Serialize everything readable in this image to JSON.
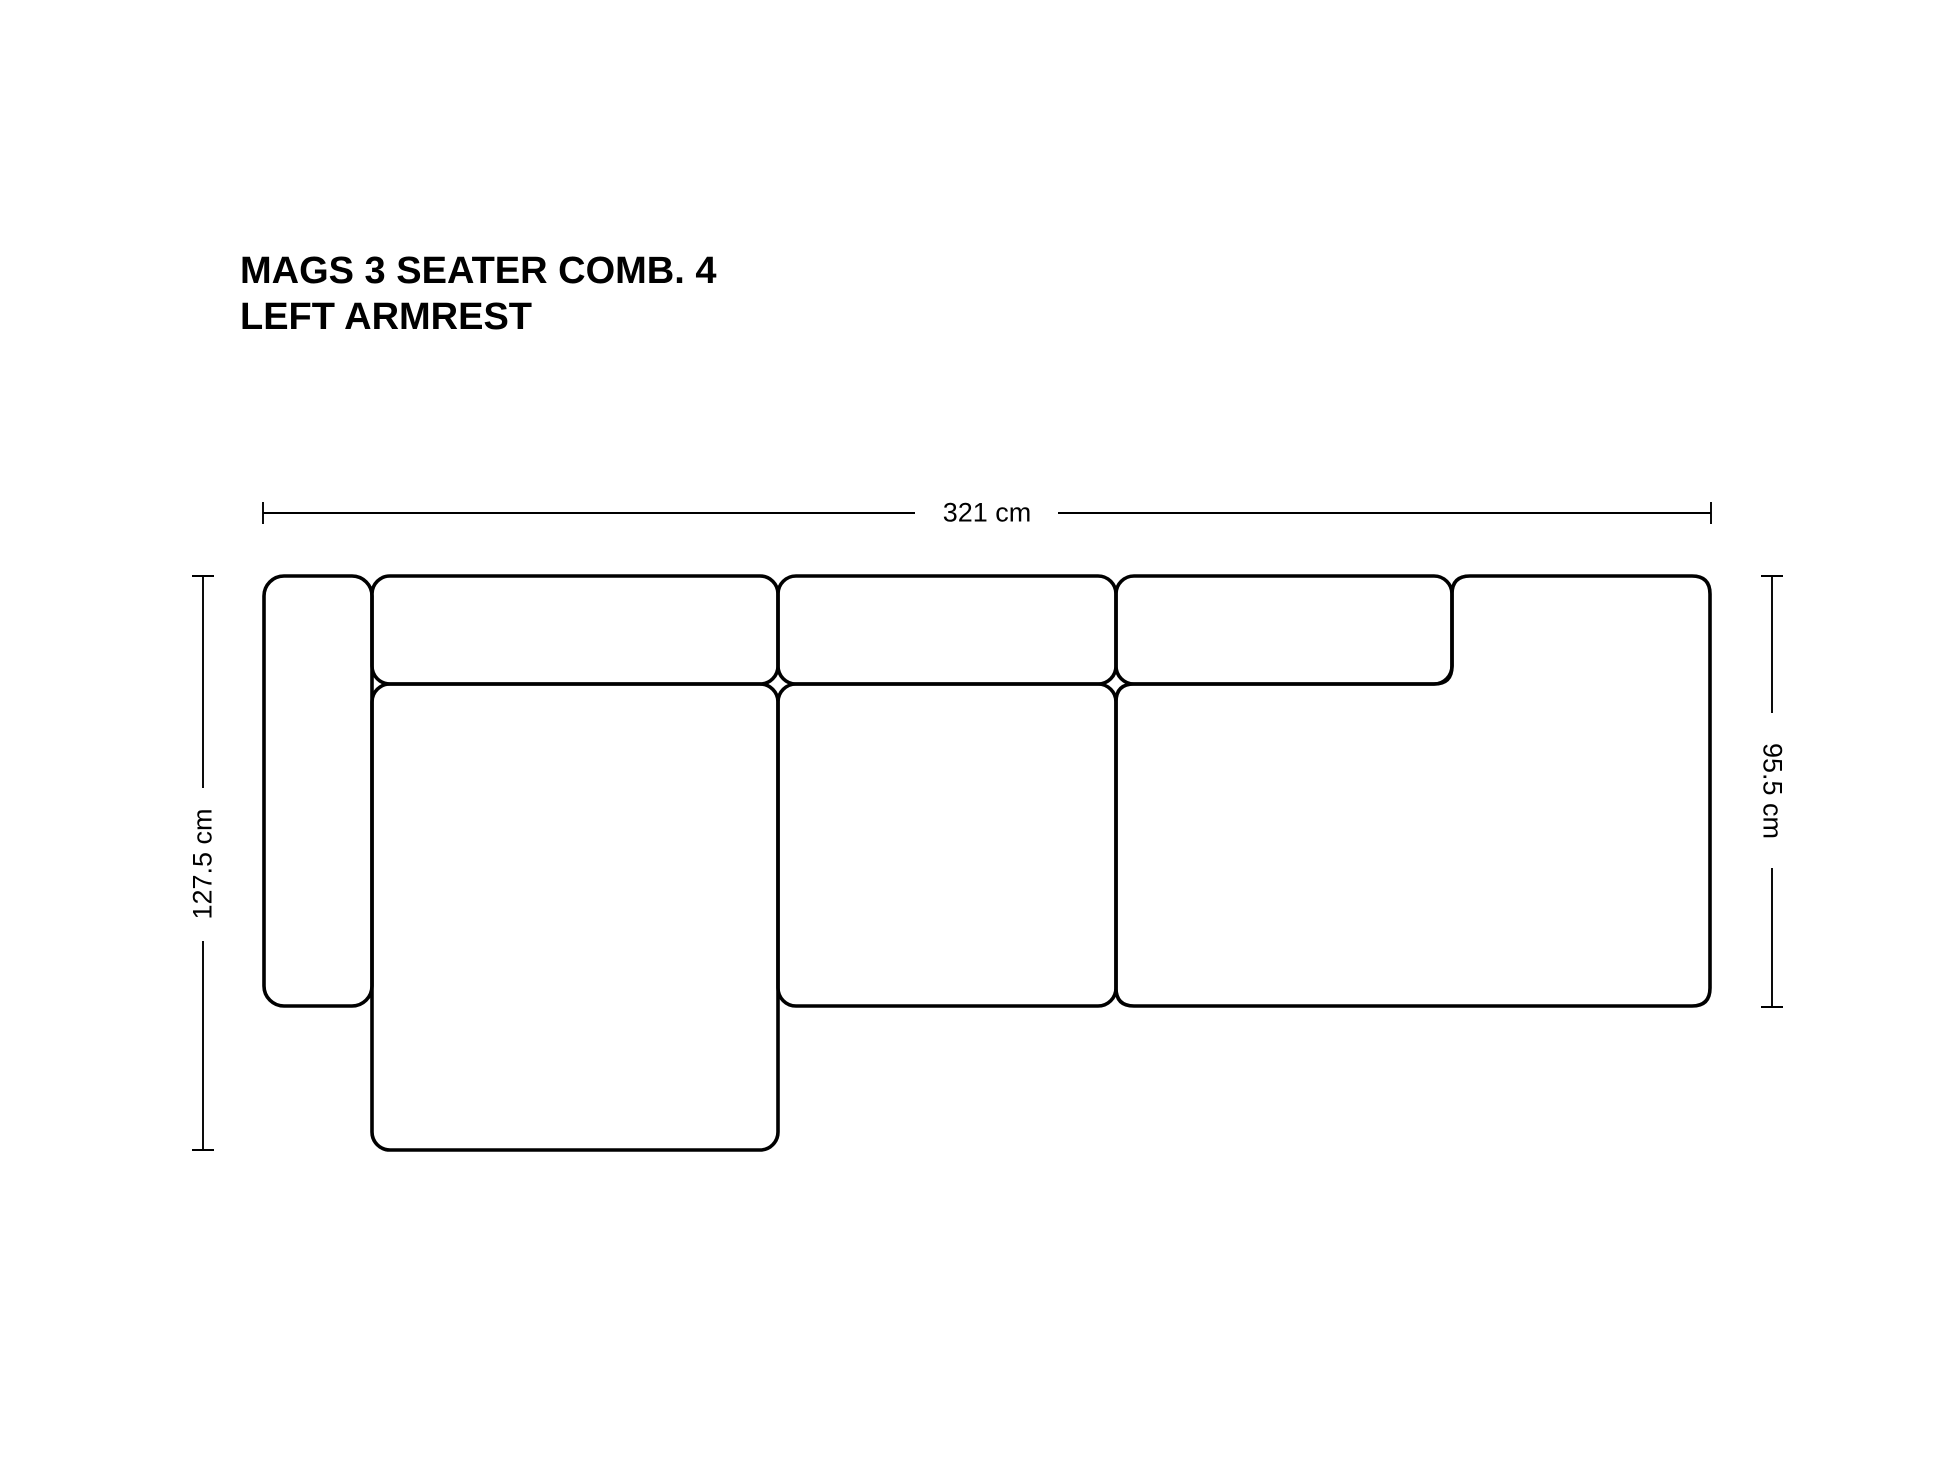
{
  "title": {
    "line1": "MAGS 3 SEATER COMB. 4",
    "line2": "LEFT ARMREST"
  },
  "dimensions": {
    "width": {
      "label": "321 cm"
    },
    "total_depth": {
      "label": "127.5 cm"
    },
    "module_depth": {
      "label": "95.5 cm"
    }
  },
  "colors": {
    "ink": "#000000",
    "background": "#ffffff"
  }
}
